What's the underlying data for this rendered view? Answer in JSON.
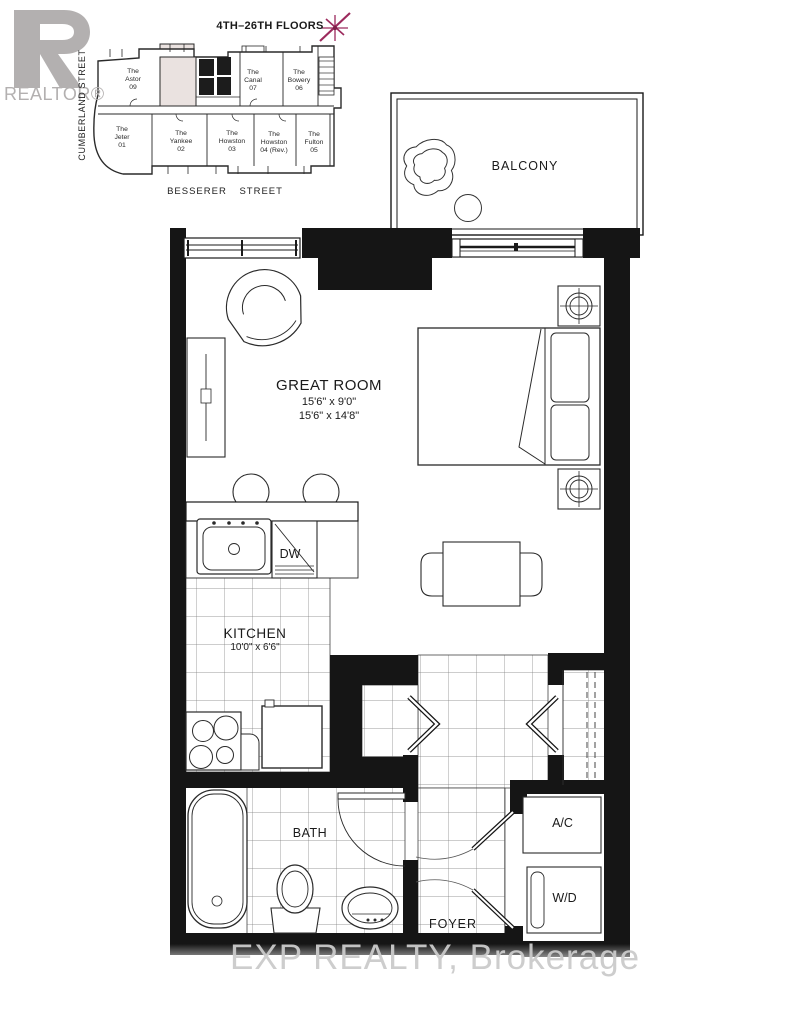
{
  "branding": {
    "realtor_wordmark": "REALTOR®"
  },
  "key_plan": {
    "title": "4TH–26TH FLOORS",
    "street_left": "CUMBERLAND STREET",
    "street_bottom": "BESSERER STREET",
    "highlight_color": "#eae2e0",
    "star_color": "#9c2a5d",
    "units": [
      {
        "prefix": "The",
        "name": "Astor",
        "number": "09"
      },
      {
        "prefix": "The",
        "name": "Canal",
        "number": "07"
      },
      {
        "prefix": "The",
        "name": "Bowery",
        "number": "06"
      },
      {
        "prefix": "The",
        "name": "Jeter",
        "number": "01"
      },
      {
        "prefix": "The",
        "name": "Yankee",
        "number": "02"
      },
      {
        "prefix": "The",
        "name": "Howston",
        "number": "03"
      },
      {
        "prefix": "The",
        "name": "Howston",
        "number": "04 (Rev.)"
      },
      {
        "prefix": "The",
        "name": "Fulton",
        "number": "05"
      }
    ]
  },
  "rooms": {
    "balcony": {
      "label": "BALCONY"
    },
    "great_room": {
      "label": "GREAT ROOM",
      "dim1": "15'6\" x 9'0\"",
      "dim2": "15'6\" x 14'8\""
    },
    "kitchen": {
      "label": "KITCHEN",
      "dim1": "10'0\" x 6'6\""
    },
    "bath": {
      "label": "BATH"
    },
    "foyer": {
      "label": "FOYER"
    }
  },
  "fixtures": {
    "dishwasher": "DW",
    "air_conditioner": "A/C",
    "washer_dryer": "W/D"
  },
  "watermark": "EXP REALTY, Brokerage"
}
